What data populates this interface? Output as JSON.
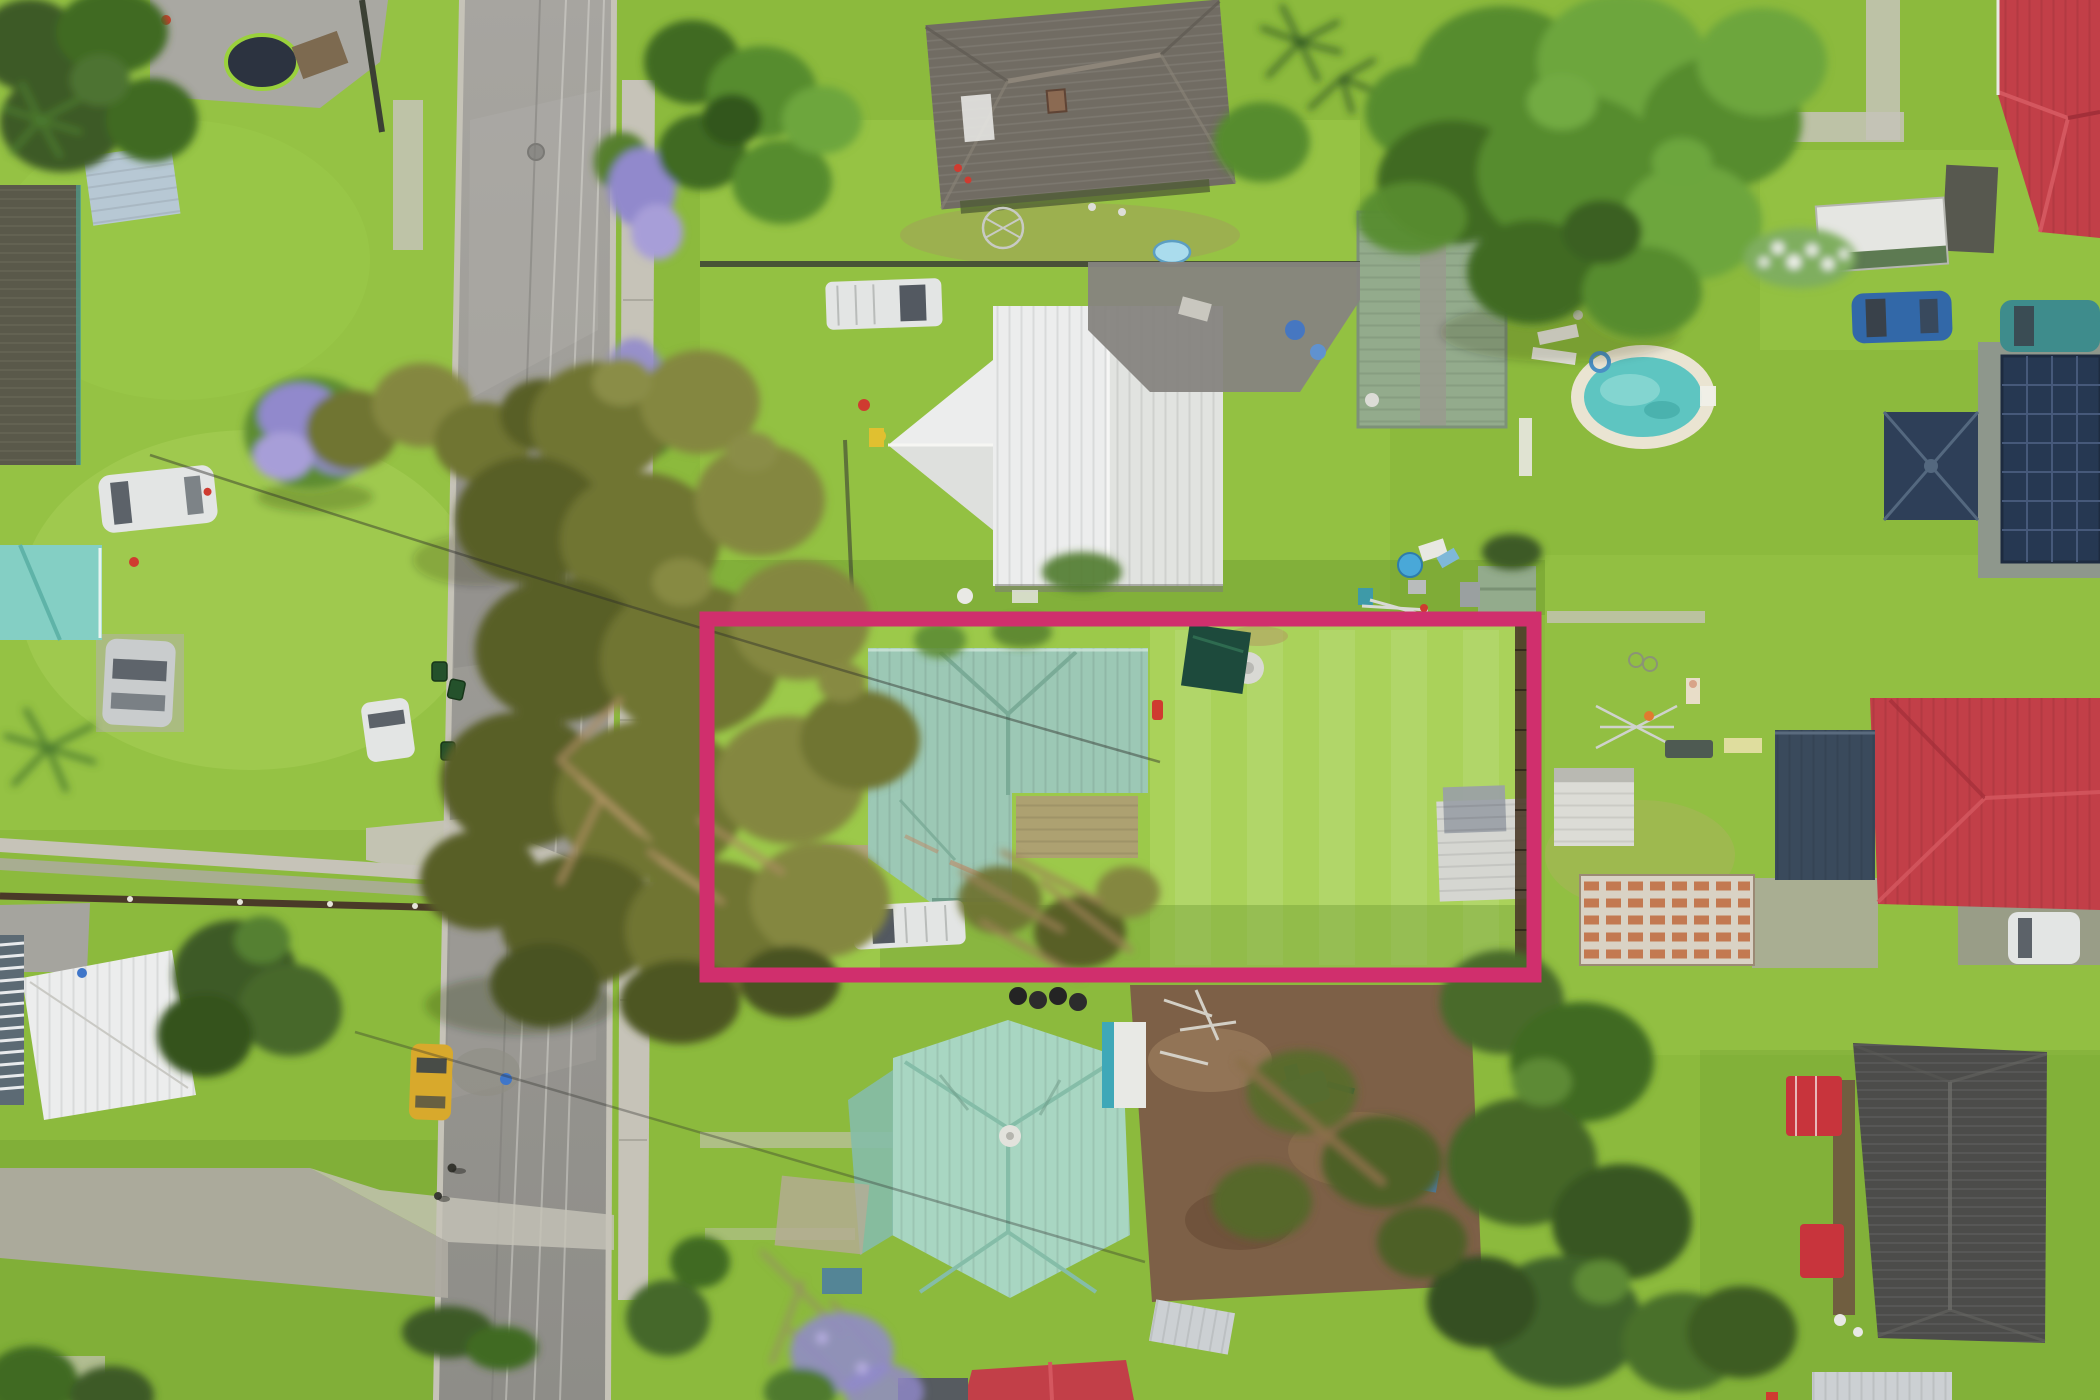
{
  "meta": {
    "type": "aerial-drone-photograph",
    "subject": "suburban residential block with real-estate property boundary overlay",
    "width_px": 2100,
    "height_px": 1400,
    "visible_text": "none"
  },
  "palette": {
    "boundary_pink": "#d02f6d",
    "lawn_base": "#8cba3d",
    "lawn_bright": "#9cc94a",
    "lawn_light": "#aed45e",
    "lawn_dark": "#6e9c31",
    "concrete": "#c6c3b8",
    "concrete_dark": "#adaaa0",
    "road_top": "#a7a5a0",
    "road_bottom": "#8e8d88",
    "white": "#eceded",
    "roof_white_shade": "#d9dad5",
    "roof_teal": "#9cc8b5",
    "roof_teal_dark": "#7aab97",
    "roof_mint": "#a8d6c2",
    "roof_mint_dark": "#85bda8",
    "roof_dark_shingle": "#716c63",
    "roof_dark_shingle_light": "#8d8579",
    "roof_left_dark": "#5b554c",
    "roof_red": "#c23f48",
    "roof_red_light": "#d4575f",
    "roof_charcoal": "#4c4c4a",
    "roof_silver": "#ccd0d3",
    "roof_sage": "#93ab8c",
    "roof_navy": "#3a4a5c",
    "solar_panel": "#263852",
    "pool_rim": "#eae4d2",
    "pool_water": "#5ec5c1",
    "pool_water_light": "#90dad4",
    "tree_olive": "#6f7433",
    "tree_olive_dark": "#585e28",
    "tree_olive_light": "#84873f",
    "tree_green": "#578c2f",
    "tree_green_light": "#6da63c",
    "tree_green_dark": "#3f6b22",
    "tree_deep": "#3c5a26",
    "jacaranda": "#9189cc",
    "branch_brown": "#ab8d60",
    "dirt": "#7d6047",
    "dirt_light": "#97795a",
    "car_white": "#e3e5e4",
    "car_silver": "#c9cccd",
    "car_yellow": "#d8a92c",
    "car_blue": "#3268a8",
    "car_teal": "#3e8c8c",
    "glass_dark": "#39414a",
    "fence_dark": "#3b4034",
    "fence_brown": "#4a3a28",
    "tarp_green": "#1d4a3c",
    "accent_red": "#cf3b30",
    "accent_yellow": "#e0c030",
    "accent_blue": "#3f76c9",
    "deck_tan": "#b09a78"
  },
  "overlay": {
    "name": "property-boundary",
    "shape": "rectangle",
    "x": 707,
    "y": 619,
    "width": 827,
    "height": 356,
    "stroke_width": 15,
    "color_ref": "boundary_pink"
  },
  "scene": {
    "objects": [
      {
        "name": "street",
        "kind": "road",
        "location": "vertical band left third, slight curve"
      },
      {
        "name": "property-boundary-overlay",
        "kind": "marketing-outline",
        "color": "boundary_pink"
      },
      {
        "name": "subject-house",
        "kind": "house",
        "roof": "roof_teal",
        "location": "inside boundary, left half"
      },
      {
        "name": "subject-backyard-lawn",
        "kind": "lawn",
        "location": "inside boundary, right half"
      },
      {
        "name": "shade-tarp-structure",
        "kind": "garden structure",
        "color": "tarp_green",
        "location": "inside boundary, top centre"
      },
      {
        "name": "white-ute-subject-driveway",
        "kind": "vehicle",
        "location": "inside boundary, bottom left"
      },
      {
        "name": "front-neighbour-house-white-roof",
        "kind": "house",
        "roof": "white",
        "location": "above boundary"
      },
      {
        "name": "white-ute-front-neighbour",
        "kind": "vehicle",
        "location": "above white-roof house"
      },
      {
        "name": "top-street-house-dark-shingle",
        "kind": "house",
        "roof": "roof_dark_shingle",
        "location": "top centre"
      },
      {
        "name": "rear-neighbour-house-mint-roof",
        "kind": "house",
        "roof": "roof_mint",
        "location": "bottom centre"
      },
      {
        "name": "right-house-red-roof",
        "kind": "house",
        "roof": "roof_red",
        "location": "right edge, middle"
      },
      {
        "name": "top-right-house-red-roof",
        "kind": "house",
        "roof": "roof_red",
        "location": "top right corner"
      },
      {
        "name": "solar-panel-roof-house",
        "kind": "house",
        "roof": "solar_panel",
        "location": "right edge"
      },
      {
        "name": "navy-gazebo",
        "kind": "gazebo",
        "roof": "roof_navy"
      },
      {
        "name": "bottom-right-house-charcoal-roof",
        "kind": "house",
        "roof": "roof_charcoal"
      },
      {
        "name": "left-edge-house-dark-roof",
        "kind": "house",
        "roof": "roof_left_dark"
      },
      {
        "name": "left-edge-house-teal-roof",
        "kind": "house",
        "roof": "pool_water"
      },
      {
        "name": "bottom-left-building-white-roof",
        "kind": "building",
        "roof": "white"
      },
      {
        "name": "swimming-pool",
        "kind": "pool",
        "location": "upper right yard"
      },
      {
        "name": "green-garden-shed",
        "kind": "shed",
        "roof": "roof_sage"
      },
      {
        "name": "rusty-shed-roof",
        "kind": "shed",
        "location": "right of boundary"
      },
      {
        "name": "white-sheds-right",
        "kind": "shed",
        "count": 2
      },
      {
        "name": "box-truck-top-right",
        "kind": "vehicle"
      },
      {
        "name": "blue-car-right",
        "kind": "vehicle"
      },
      {
        "name": "teal-car-right-edge",
        "kind": "vehicle"
      },
      {
        "name": "white-car-right-driveway",
        "kind": "vehicle"
      },
      {
        "name": "yellow-car-on-road",
        "kind": "vehicle"
      },
      {
        "name": "debris-pile-beside-yellow-car",
        "kind": "debris"
      },
      {
        "name": "white-car-left-lawn",
        "kind": "vehicle"
      },
      {
        "name": "silver-car-left",
        "kind": "vehicle"
      },
      {
        "name": "white-car-road-verge",
        "kind": "vehicle"
      },
      {
        "name": "trampoline-top-left",
        "kind": "play-equipment"
      },
      {
        "name": "large-olive-tree-canopy",
        "kind": "tree",
        "location": "centre left, overhangs road and boundary"
      },
      {
        "name": "large-green-tree-top-right",
        "kind": "tree"
      },
      {
        "name": "jacaranda-trees",
        "kind": "tree",
        "color": "jacaranda",
        "count": 4
      },
      {
        "name": "fallen-tree-debris",
        "kind": "debris",
        "location": "inside boundary bottom and bottom right dirt yard"
      },
      {
        "name": "dirt-yard-bottom-centre",
        "kind": "ground",
        "color": "dirt"
      },
      {
        "name": "wheelie-bins",
        "kind": "bins",
        "count": 4
      },
      {
        "name": "clotheslines",
        "kind": "utility",
        "count": 2
      },
      {
        "name": "power-lines",
        "kind": "utility",
        "count": 2
      },
      {
        "name": "pedestrians-on-road",
        "kind": "people",
        "count": 2
      },
      {
        "name": "person-sunbathing-right-lawn",
        "kind": "people",
        "count": 1
      },
      {
        "name": "kiddie-pools-blue",
        "kind": "pool",
        "count": 2
      },
      {
        "name": "concrete-paths",
        "kind": "path",
        "count": 6
      }
    ]
  }
}
